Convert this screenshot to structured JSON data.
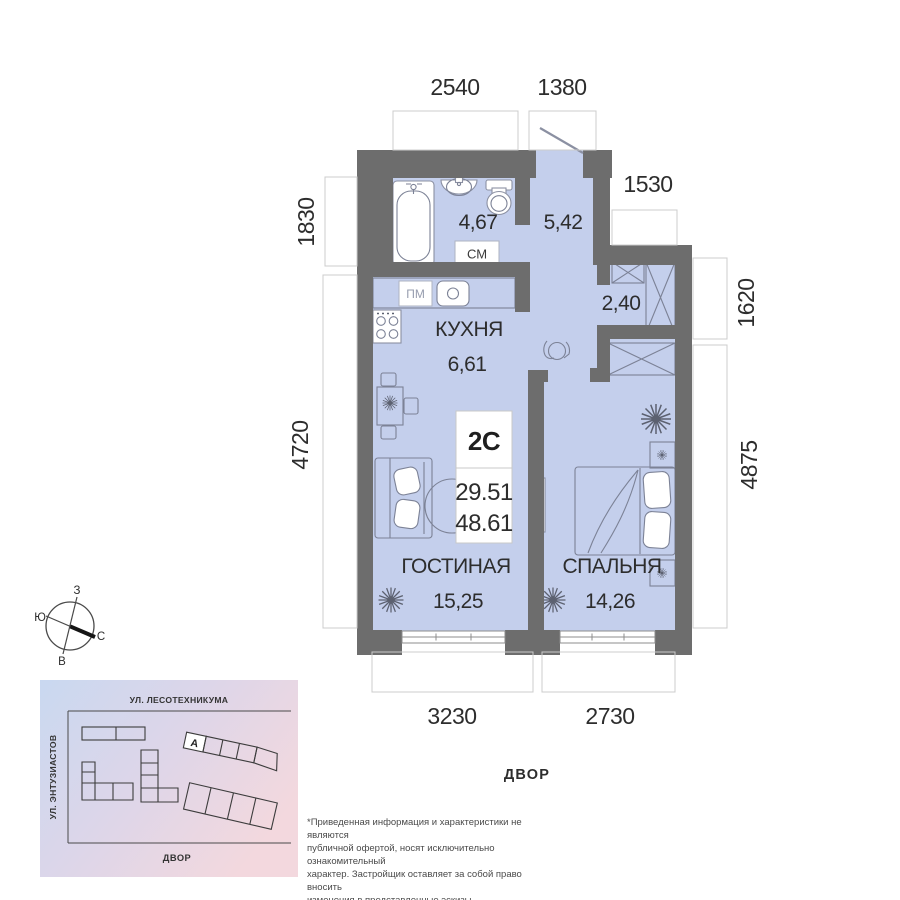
{
  "apartment": {
    "type": "2С",
    "area_living": "29.51",
    "area_total": "48.61"
  },
  "rooms": {
    "bathroom": {
      "area": "4,67"
    },
    "hall": {
      "area": "5,42"
    },
    "wardrobe": {
      "area": "2,40"
    },
    "kitchen": {
      "name": "КУХНЯ",
      "area": "6,61"
    },
    "living": {
      "name": "ГОСТИНАЯ",
      "area": "15,25"
    },
    "bedroom": {
      "name": "СПАЛЬНЯ",
      "area": "14,26"
    }
  },
  "labels": {
    "washing_machine": "СМ",
    "dishwasher": "ПМ",
    "yard": "ДВОР"
  },
  "dimensions": {
    "top_1": "2540",
    "top_2": "1380",
    "right_1": "1530",
    "right_2": "1620",
    "right_3": "4875",
    "left_1": "1830",
    "left_2": "4720",
    "bottom_1": "3230",
    "bottom_2": "2730"
  },
  "compass": {
    "west": "З",
    "south": "Ю",
    "north": "С",
    "east": "В"
  },
  "site_map": {
    "street_top": "УЛ. ЛЕСОТЕХНИКУМА",
    "street_left": "УЛ. ЭНТУЗИАСТОВ",
    "yard": "ДВОР",
    "building": "А"
  },
  "disclaimer": "*Приведенная информация и характеристики не являются\nпубличной офертой, носят исключительно ознакомительный\nхарактер. Застройщик оставляет за собой право вносить\nизменения в представленные эскизы.",
  "colors": {
    "floor": "#c4cfec",
    "wall": "#6d6d6d",
    "map_blue": "#c9d8f0",
    "map_pink": "#f3d8de"
  }
}
